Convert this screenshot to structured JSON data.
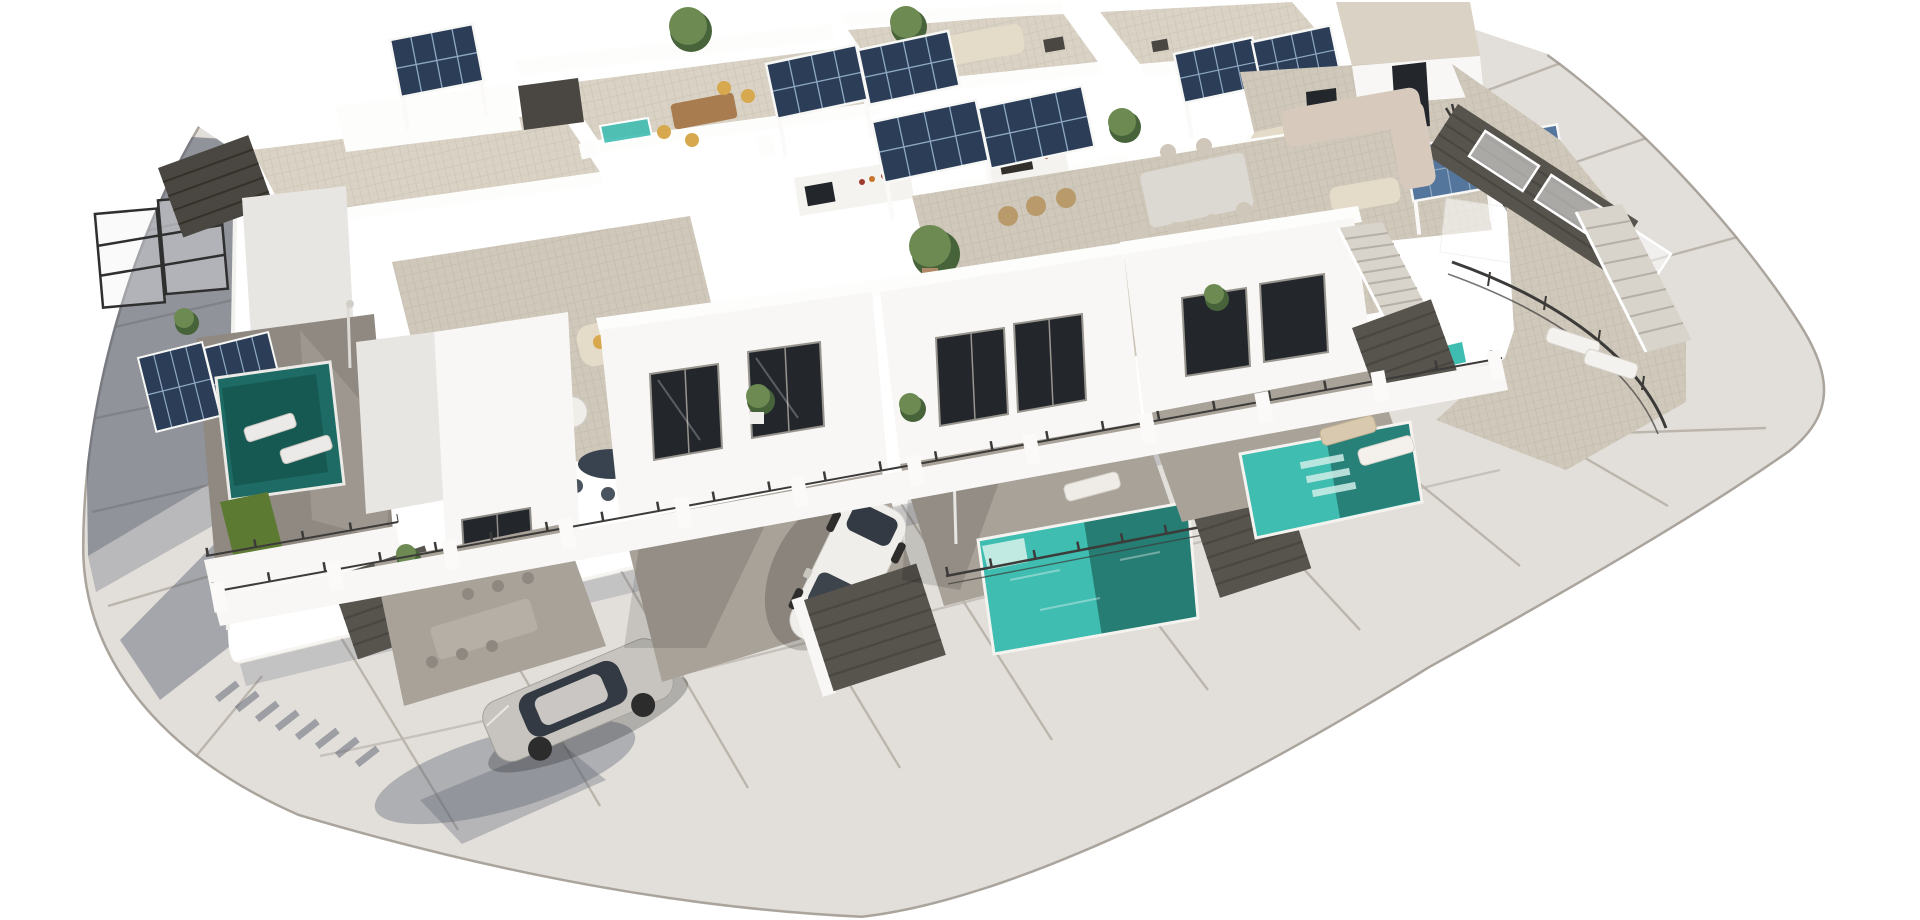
{
  "meta": {
    "title": "Aerial 3D architectural render of a modern white villa development",
    "image_type": "architectural-visualization",
    "canvas": {
      "width": 1920,
      "height": 920
    }
  },
  "scene": {
    "description": "High-angle aerial 3D rendering of a block of modern flat-roofed white villas with rooftop terraces, solar-panel pergolas, outdoor kitchens, private turquoise pools, louvred entry gates and two parked cars, surrounded by a rounded rectangular perimeter road of large pale paving slabs on a plain white background. Sunlight comes from the upper right, casting long blue-grey shadows to the lower left.",
    "sky": "plain white background",
    "lighting": "sunlight from upper right; shadows fall to lower left"
  },
  "colors": {
    "background": "#ffffff",
    "road": "#e2dfda",
    "road_seam": "#b7b1a8",
    "road_curb": "#a09a92",
    "sidewalk": "#edebe6",
    "shadow": "#5a6170",
    "wall": "#f8f7f5",
    "wall_shade": "#e8e6e2",
    "parapet": "#fdfdfc",
    "roof_tile": "#d9d2c5",
    "terrace_tile": "#cfc8bb",
    "patio": "#a9a299",
    "patio_shade": "#8f8982",
    "solar": "#2c3e57",
    "solar_light": "#54769c",
    "solar_grid": "#8fa9c4",
    "pool": "#3fbdb0",
    "pool_dark": "#14514b",
    "pool_shade": "#1d6b64",
    "glass": "#23272c",
    "gate": "#57534d",
    "gate_dark": "#4a4742",
    "railing": "#3c3b39",
    "plant": "#6c8a52",
    "plant_dark": "#47633a",
    "grass": "#5d7a33",
    "car_white": "#f0eeea",
    "car_silver": "#c7c4bf",
    "car_glass": "#333a43",
    "sofa_cream": "#e4dbc8",
    "sofa_blush": "#d8c9bd",
    "cushion": "#d8a84e",
    "wood": "#a97c4f",
    "table_gray": "#b6afa5",
    "table_white": "#dcd8d2",
    "step": "#d8d3cb",
    "stone": "#e9e6e1",
    "white": "#fbfaf9"
  },
  "inventory": {
    "villas": 6,
    "rooftop_terraces": 6,
    "solar_pergolas": 8,
    "swimming_pools": 5,
    "cars": 2,
    "entry_gates": 6,
    "staircases": 2,
    "sun_loungers": 9,
    "outdoor_dining_sets": 4,
    "outdoor_sofas": 4,
    "outdoor_kitchens": 2,
    "potted_plants": 12
  },
  "objects": {
    "road": {
      "name": "perimeter road",
      "surface": "large light-grey paving slabs with expansion joints and kerb",
      "shape": "rounded rectangular loop around the block"
    },
    "white_car": {
      "name": "white hatchback",
      "location": "centre driveway behind louvre gate"
    },
    "silver_car": {
      "name": "silver hatchback",
      "location": "lower-left driveway"
    },
    "pools": [
      "shaded courtyard pool (left villa)",
      "turquoise pool (centre front villa)",
      "turquoise pool (right front villa)",
      "small rooftop plunge pool (top centre)",
      "corner pool glimpse (right terrace)"
    ]
  }
}
